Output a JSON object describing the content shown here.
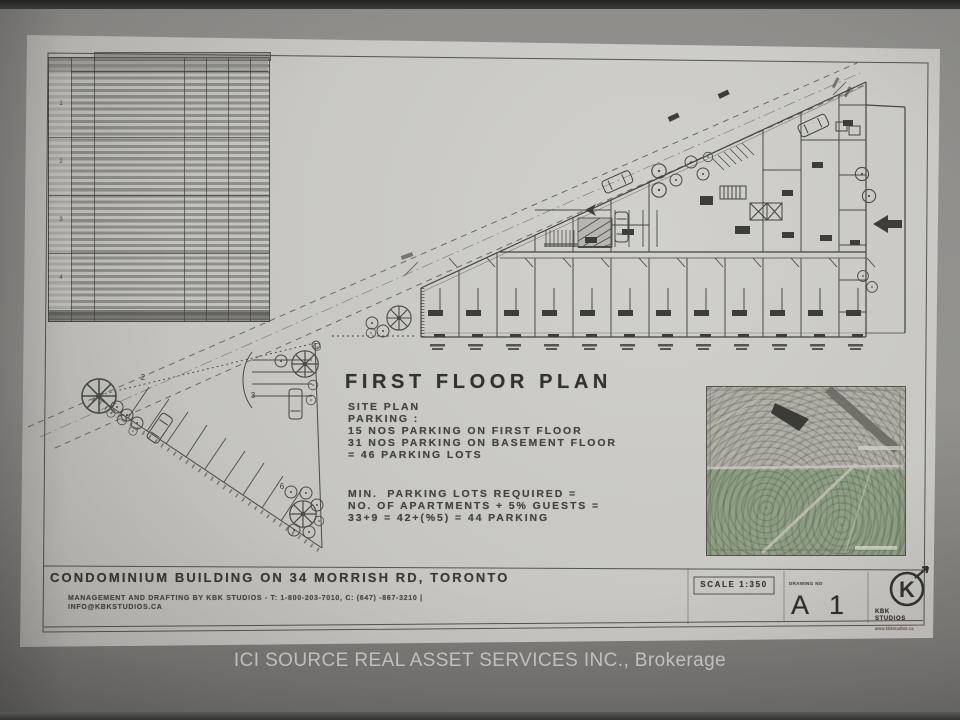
{
  "photo": {
    "watermark": "ICI SOURCE REAL ASSET SERVICES INC., Brokerage"
  },
  "sheet": {
    "heading": "FIRST FLOOR PLAN",
    "site_notes": [
      "SITE PLAN",
      "PARKING :",
      "15 NOS PARKING ON FIRST FLOOR",
      "31 NOS PARKING ON BASEMENT FLOOR",
      "= 46 PARKING LOTS"
    ],
    "parking_calc": [
      "MIN.  PARKING LOTS REQUIRED =",
      "NO. OF APARTMENTS + 5% GUESTS =",
      "33+9 = 42+(%5) = 44 PARKING"
    ],
    "plan_labels": {
      "area2": "2",
      "area3": "3",
      "area6": "6"
    },
    "schedule_groups": [
      "1",
      "2",
      "3",
      "4"
    ],
    "titleblock": {
      "project_title": "CONDOMINIUM BUILDING ON 34 MORRISH RD, TORONTO",
      "credits": "MANAGEMENT AND DRAFTING BY KBK STUDIOS - T: 1-800-203-7010, C: (647) -867-3210 |",
      "email": "INFO@KBKSTUDIOS.CA",
      "scale": "SCALE 1:350",
      "drawing_no_label": "DRAWING NO",
      "sheet_no": "A 1",
      "logo_letter": "K",
      "logo_name": "KBK STUDIOS",
      "logo_url": "www.kbkstudios.ca"
    }
  },
  "colors": {
    "paper": "#c8c7c3",
    "ink": "#44443f",
    "background_gray": "#8f8e8b",
    "map_green": "#90a086",
    "logo_url_red": "#7c4f46"
  }
}
